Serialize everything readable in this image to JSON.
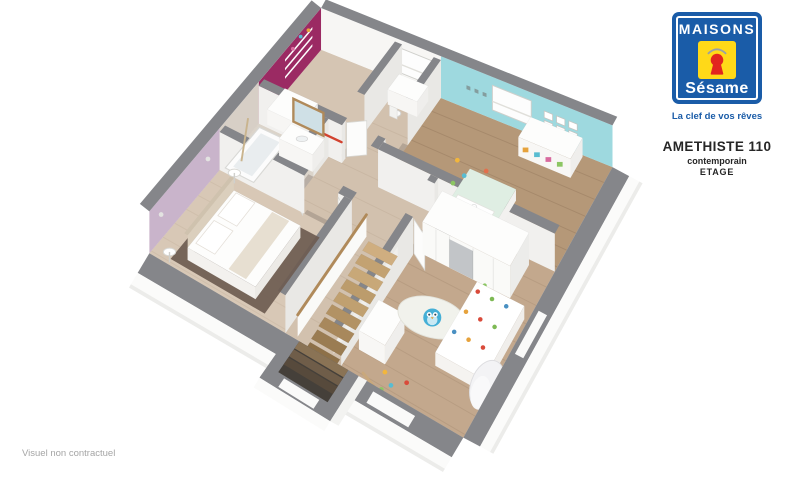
{
  "branding": {
    "brand_name": "MAISONS",
    "brand_sub": "Sésame",
    "tagline": "La clef de vos rêves",
    "model_name": "AMETHISTE 110",
    "model_style": "contemporain",
    "model_level": "ETAGE"
  },
  "caption": "Visuel non contractuel",
  "icons": {
    "keyhole_icon": "keyhole-in-yellow-square-with-roof",
    "logo_shape": "blue-square-white-keyline"
  },
  "rooms": [
    {
      "id": "bedroom-magenta",
      "accent_wall": "#9b2a63"
    },
    {
      "id": "bathroom",
      "accent_wall": "#d7cfc6"
    },
    {
      "id": "bedroom-parents",
      "accent_wall": "#c9b4cb"
    },
    {
      "id": "bedroom-cyan",
      "accent_wall": "#9ed9df"
    },
    {
      "id": "bedroom-kids",
      "accent_wall": null
    },
    {
      "id": "landing-stairs",
      "accent_wall": null
    }
  ],
  "colors": {
    "page_bg": "#ffffff",
    "wall_top_gray": "#85868a",
    "wall_white": "#f7f6f4",
    "partition_face": "#f1f0ee",
    "partition_side": "#e9e8e5",
    "accent_magenta": "#9b2a63",
    "accent_cyan": "#9ed9df",
    "accent_mauve": "#c9b4cb",
    "bath_greige": "#d7cfc6",
    "floor_light": "#d2c1ae",
    "floor_mid": "#b59878",
    "floor_kids": "#c3a88d",
    "floor_bath": "#dbd4ca",
    "floor_mauve": "#d8c8b6",
    "floor_magenta": "#d5c5b3",
    "rug_dark": "#6e5c51",
    "rug_kids": "#f1f2ec",
    "owl_blue": "#45afd6",
    "wood_stair": "#c5a476",
    "wood_frame": "#b08a5a",
    "bed_mint": "#dfeee3",
    "drape_white": "#f3f3f5",
    "door_shadow": "#8d8177",
    "logo_blue": "#1a5ca8",
    "logo_yellow": "#ffd918",
    "logo_red": "#e2251f",
    "title_dark": "#262626",
    "caption_gray": "#a5a5a5"
  }
}
